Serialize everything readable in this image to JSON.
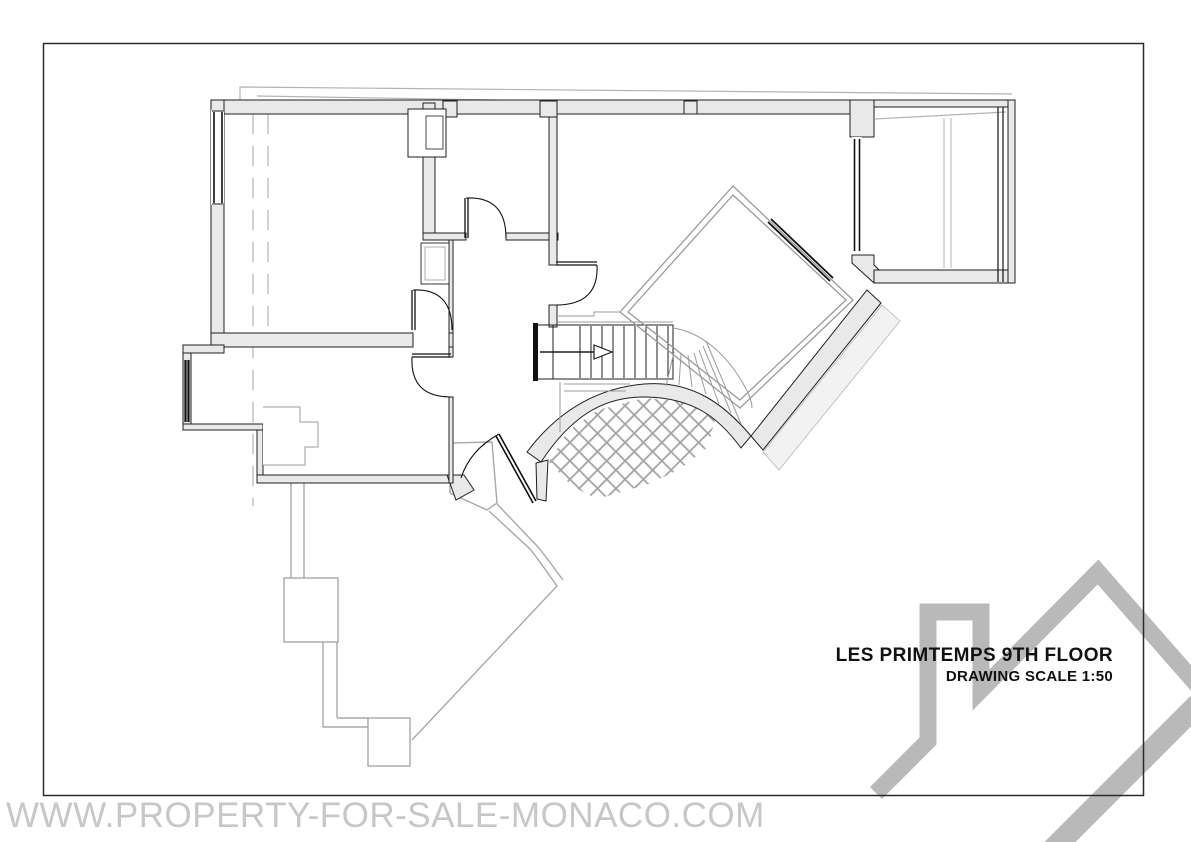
{
  "title_block": {
    "title": "LES PRIMTEMPS 9TH FLOOR",
    "scale_note": "DRAWING SCALE 1:50"
  },
  "watermark": {
    "url_text": "WWW.PROPERTY-FOR-SALE-MONACO.COM"
  },
  "icons": {
    "logo": "roof-chimney-logo",
    "stairs_arrow": "stairs-direction-arrow"
  },
  "colors": {
    "wall_fill": "#e9e9e9",
    "line": "#1f1f1f",
    "plan_gray": "#9b9b9b",
    "terrace_gray": "#a8a8a8",
    "overhang_gray": "#b3b3b3",
    "hatch": "#a3a3a3",
    "walkway_fill": "#f2f2f2",
    "logo": "#b9b9b9",
    "watermark": "#c7c7c7",
    "title": "#111111"
  }
}
